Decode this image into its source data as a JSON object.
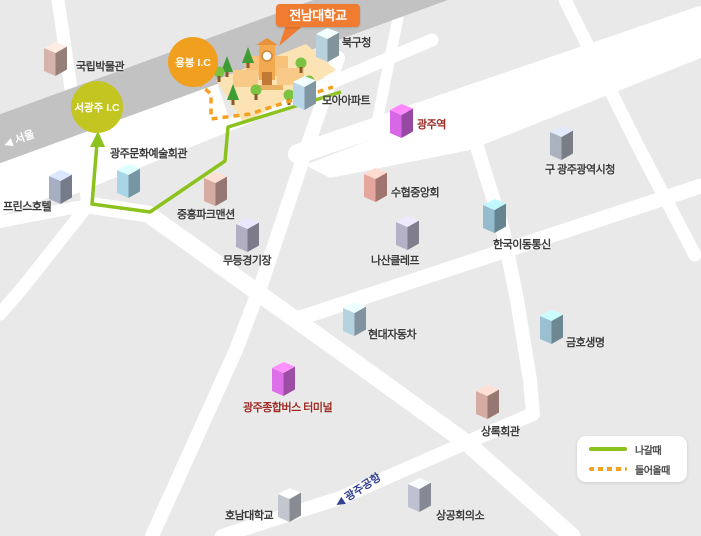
{
  "callout": {
    "label": "전남대학교",
    "color": "#ef7c30"
  },
  "interchanges": [
    {
      "id": "yongbong-ic",
      "label": "용봉 I.C",
      "color": "#f0a01e"
    },
    {
      "id": "seogwangju-ic",
      "label": "서광주 I.C",
      "color": "#c3c521"
    }
  ],
  "road_labels": {
    "seoul": "◀ 서울",
    "airport": "◀ 광주공항"
  },
  "routes": {
    "exit": {
      "label": "나갈때",
      "style": "solid",
      "color": "#8cc21d"
    },
    "enter": {
      "label": "들어올때",
      "style": "dotted",
      "color": "#f5a01f"
    }
  },
  "theme": {
    "block_gray": "#e9e9e9",
    "road_white": "#ffffff",
    "highway_gray": "#c2c2c2",
    "label_color": "#3b3b3b",
    "red_label_color": "#9c2b24",
    "airport_label_color": "#33408f",
    "campus_ground": "#fbe3b4"
  },
  "buildings": [
    {
      "id": "national-museum",
      "label": "국립박물관",
      "color": "#c5a69f",
      "x": 44,
      "y": 40,
      "lx": 76,
      "ly": 58
    },
    {
      "id": "bukgu-office",
      "label": "북구청",
      "color": "#abc1cd",
      "x": 316,
      "y": 26,
      "lx": 342,
      "ly": 34
    },
    {
      "id": "moa-apartment",
      "label": "모아아파트",
      "color": "#aac6d6",
      "x": 293,
      "y": 74,
      "lx": 322,
      "ly": 92
    },
    {
      "id": "gwangju-station",
      "label": "광주역",
      "color": "#c75fd6",
      "label_color": "#9c2b24",
      "x": 390,
      "y": 102,
      "lx": 417,
      "ly": 116
    },
    {
      "id": "old-city-hall",
      "label": "구 광주광역시청",
      "color": "#9fa4b0",
      "x": 550,
      "y": 124,
      "lx": 545,
      "ly": 161
    },
    {
      "id": "suhyup-federation",
      "label": "수협중앙회",
      "color": "#d49a92",
      "x": 364,
      "y": 166,
      "lx": 391,
      "ly": 184
    },
    {
      "id": "nasan-clef",
      "label": "나산클레프",
      "color": "#a8a4b8",
      "x": 396,
      "y": 214,
      "lx": 371,
      "ly": 252
    },
    {
      "id": "korea-mobile-telecom",
      "label": "한국이동통신",
      "color": "#88aebf",
      "x": 483,
      "y": 197,
      "lx": 493,
      "ly": 236
    },
    {
      "id": "mudeung-stadium",
      "label": "무등경기장",
      "color": "#a5a2b4",
      "x": 236,
      "y": 216,
      "lx": 223,
      "ly": 252
    },
    {
      "id": "jungheung-park-mansion",
      "label": "중흥파크맨션",
      "color": "#c69e96",
      "x": 204,
      "y": 170,
      "lx": 177,
      "ly": 206
    },
    {
      "id": "hyundai-motor",
      "label": "현대자동차",
      "color": "#a8c2d0",
      "x": 343,
      "y": 300,
      "lx": 368,
      "ly": 326
    },
    {
      "id": "kumho-life",
      "label": "금호생명",
      "color": "#8fb2c2",
      "x": 540,
      "y": 308,
      "lx": 566,
      "ly": 334
    },
    {
      "id": "bus-terminal",
      "label": "광주종합버스 터미널",
      "color": "#cd67d8",
      "label_color": "#9c2b24",
      "x": 272,
      "y": 360,
      "lx": 243,
      "ly": 399
    },
    {
      "id": "sangnok-hall",
      "label": "상록회관",
      "color": "#c69e96",
      "x": 476,
      "y": 383,
      "lx": 481,
      "ly": 423
    },
    {
      "id": "chamber-of-commerce",
      "label": "상공회의소",
      "color": "#b0b3c2",
      "x": 408,
      "y": 476,
      "lx": 436,
      "ly": 507
    },
    {
      "id": "honam-university",
      "label": "호남대학교",
      "color": "#b4b7c0",
      "x": 278,
      "y": 486,
      "lx": 225,
      "ly": 507
    },
    {
      "id": "prince-hotel",
      "label": "프린스호텔",
      "color": "#9aa2b4",
      "x": 49,
      "y": 168,
      "lx": 3,
      "ly": 198
    },
    {
      "id": "culture-art-center",
      "label": "광주문화예술회관",
      "color": "#9cc5d6",
      "x": 117,
      "y": 162,
      "lx": 110,
      "ly": 145
    }
  ]
}
